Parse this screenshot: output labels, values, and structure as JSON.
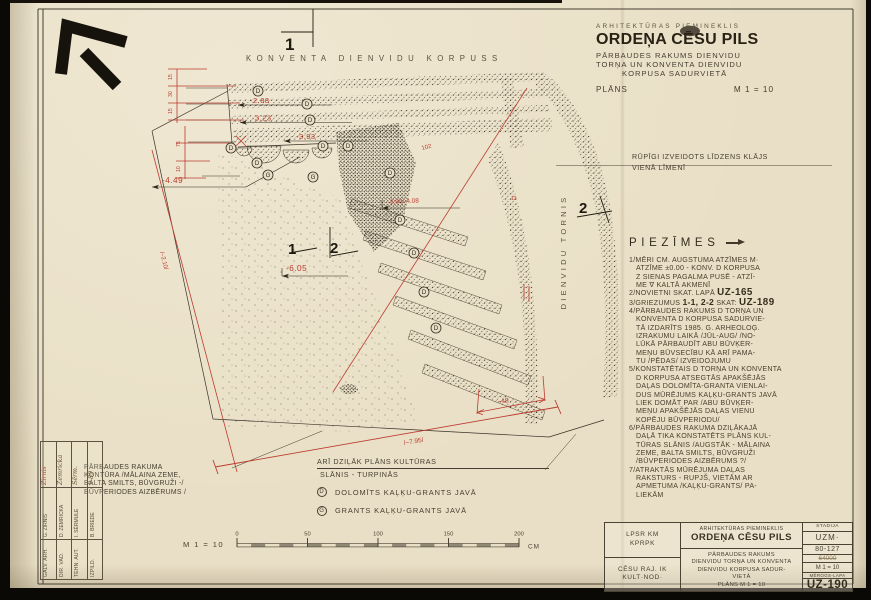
{
  "header": {
    "eyebrow": "ARHITEKTŪRAS PIEMINEKLIS",
    "title": "ORDEŅA CĒSU PILS",
    "sub1": "PĀRBAUDES RAKUMS DIENVIDU",
    "sub2": "TORŅA UN KONVENTA DIENVIDU",
    "sub3": "KORPUSA SADURVIETĀ",
    "plans_label": "PLĀNS",
    "scale": "M 1 = 10"
  },
  "drawing": {
    "wall_label": "KONVENTA DIENVIDU KORPUSS",
    "tower_label": "DIENVIDU TORNIS",
    "level_note_1": "RŪPĪGI IZVEIDOTS LĪDZENS KLĀJS",
    "level_note_2": "VIENĀ LĪMENĪ",
    "marks": {
      "top": "1",
      "mid1": "1",
      "mid2": "2",
      "right": "2"
    },
    "mat_d": "D",
    "mat_g": "G",
    "elev": {
      "e288": "-2.88",
      "e323": "-3.23",
      "e393": "-3.93",
      "e449": "-4.49",
      "e605": "-6.05",
      "e398": "-3.98/-4.08",
      "v102": "102",
      "v13": "13",
      "d48": "~48",
      "d795": "/~7.95/",
      "d210": "/~2.10/"
    },
    "chain": {
      "c1": "15",
      "c2": "30",
      "c3": "15",
      "c4": "75",
      "c5": "10"
    }
  },
  "notes": {
    "title": "PIEZĪMES",
    "n1": [
      "1/MĒRI CM. AUGSTUMA ATZĪMES M·",
      "ATZĪME ±0.00 - KONV. D KORPUSA",
      "Z SIENAS PAGALMA PUSĒ - ATZĪ-",
      "ME ∇ KALTĀ AKMENĪ"
    ],
    "n2_pre": "2/NOVIETNI SKAT. LAPĀ",
    "n2_ref": "UZ-165",
    "n3_pre": "3/GRIEZUMUS",
    "n3_mid": "1-1, 2-2",
    "n3_post": "SKAT:",
    "n3_ref": "UZ-189",
    "n4": [
      "4/PĀRBAUDES RAKUMS D TORŅA UN",
      "KONVENTA D KORPUSA SADURVIE-",
      "TĀ IZDARĪTS 1985. G. ARHEOLOĢ.",
      "IZRAKUMU LAIKĀ /JŪL-AUG/ /NO-",
      "LŪKĀ PĀRBAUDĪT ABU BŪVĶER-",
      "MEŅU BŪVSECĪBU KĀ ARĪ PAMA-",
      "TU /PĒDAS/ IZVEIDOJUMU"
    ],
    "n5": [
      "5/KONSTATĒTAIS D TORŅA UN KONVENTA",
      "D KORPUSA ATSEGTĀS APAKŠĒJĀS",
      "DAĻAS DOLOMĪTA-GRANTA VIENLAI-",
      "DUS MŪRĒJUMS KAĻĶU-GRANTS JAVĀ",
      "LIEK DOMĀT PAR /ABU BŪVĶER-",
      "MEŅU APAKŠĒJĀS DAĻAS VIENU",
      "KOPĒJU BŪVPERIODU/"
    ],
    "n6": [
      "6/PĀRBAUDES RAKUMA DZIĻĀKAJĀ",
      "DAĻĀ TIKA KONSTATĒTS PLĀNS KUL-",
      "TŪRAS SLĀNIS /AUGSTĀK - MĀLAINA",
      "ZEME, BALTA SMILTS, BŪVGRUŽI",
      "/BŪVPERIODES AIZBĒRUMS ?/"
    ],
    "n7": [
      "7/ATRAKTĀS MŪRĒJUMA DAĻAS",
      "RAKSTURS - RUPJŠ, VIETĀM AR",
      "APMETUMA /KAĻĶU-GRANTS/ PA-",
      "LIEKĀM"
    ]
  },
  "contour_note": [
    "PĀRBAUDES RAKUMA",
    "KONTŪRA /MĀLAINA ZEME,",
    "BALTA SMILTS, BŪVGRUŽI -/",
    "BŪVPERIODES AIZBĒRUMS /"
  ],
  "legend": {
    "title1": "ARĪ DZIĻĀK PLĀNS KULTŪRAS",
    "title2": "SLĀNIS - TURPINĀS",
    "d_sym": "D",
    "d_text": "DOLOMĪTS KAĻĶU-GRANTS JAVĀ",
    "g_sym": "G",
    "g_text": "GRANTS KAĻĶU-GRANTS JAVĀ"
  },
  "scalebar": {
    "label": "M 1 = 10",
    "ticks": [
      "0",
      "50",
      "100",
      "150",
      "200"
    ],
    "unit": "CM"
  },
  "titleblock": {
    "org_top_1": "LPSR KM",
    "org_top_2": "KPRPK",
    "org_bot_1": "CĒSU RAJ. IK",
    "org_bot_2": "KULT·NOD·",
    "eyebrow": "ARHITEKTŪRAS PIEMINEKLIS",
    "title": "ORDEŅA CĒSU PILS",
    "sub1": "PĀRBAUDES RAKUMS",
    "sub2": "DIENVIDU TORŅA UN KONVENTA",
    "sub3": "DIENVIDU KORPUSA SADUR-",
    "sub4": "VIETĀ",
    "sub5": "PLĀNS M 1 = 10",
    "stadija_label": "STADIJA",
    "stadija": "UZM·",
    "code": "80-127",
    "code_old": "64000",
    "scale": "M 1 = 10",
    "sheet_label": "MĒROGS-LAPA",
    "sheet": "UZ-190"
  },
  "stamp": {
    "rows": [
      {
        "role": "GALV. ARH.",
        "name": "G. ZIRNIS",
        "sig": "Zirnis"
      },
      {
        "role": "DIR. VAD.",
        "name": "D. ZEMRICKA",
        "sig": "Zemricka"
      },
      {
        "role": "TEHN. AUT.",
        "name": "I. SĒRMULE",
        "sig": "Sērm."
      },
      {
        "role": "IZPILD.",
        "name": "B. BRIEDE",
        "sig": "9-89"
      }
    ]
  },
  "colors": {
    "red": "#bc3c31",
    "ink": "#474031",
    "paper": "#e9dfc6"
  }
}
